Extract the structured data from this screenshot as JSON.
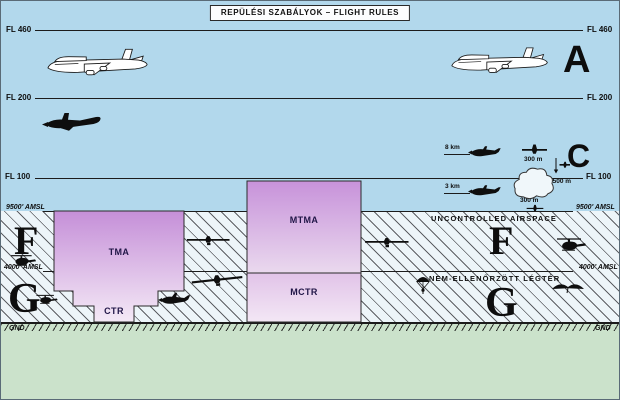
{
  "title": "REPÜLÉSI SZABÁLYOK – FLIGHT RULES",
  "levels": {
    "fl460": "FL 460",
    "fl200": "FL 200",
    "fl100": "FL 100",
    "amsl9500": "9500' AMSL",
    "amsl4000": "4000' AMSL",
    "gnd": "GND"
  },
  "airspace_classes": {
    "a": "A",
    "c": "C",
    "f": "F",
    "g": "G"
  },
  "zones": {
    "tma": "TMA",
    "ctr": "CTR",
    "mtma": "MTMA",
    "mctr": "MCTR"
  },
  "annotations": {
    "uncontrolled_en": "UNCONTROLLED AIRSPACE",
    "uncontrolled_hu": "NEM-ELLENŐRZÖTT LÉGTÉR",
    "visibility_above_fl100": "8 km",
    "visibility_below_fl100": "3 km",
    "cloud_vertical_above": "300 m",
    "cloud_horizontal": "1500 m",
    "cloud_vertical_below": "300 m"
  },
  "colors": {
    "sky": "#b2d8ec",
    "uncontrolled_bg": "#edf5f9",
    "ground_green": "#cbe2cb",
    "zone_gradient_top": "#c58fd8",
    "zone_gradient_bottom": "#f4e9f6",
    "line": "#1c1c1c"
  },
  "icons": [
    "jet-airliner",
    "turboprop-aircraft",
    "light-twin-aircraft",
    "plane-top-view",
    "plane-descent-arrow",
    "cumulus-cloud",
    "glider-top-view",
    "helicopter",
    "light-aircraft",
    "parachutist",
    "hang-glider"
  ]
}
